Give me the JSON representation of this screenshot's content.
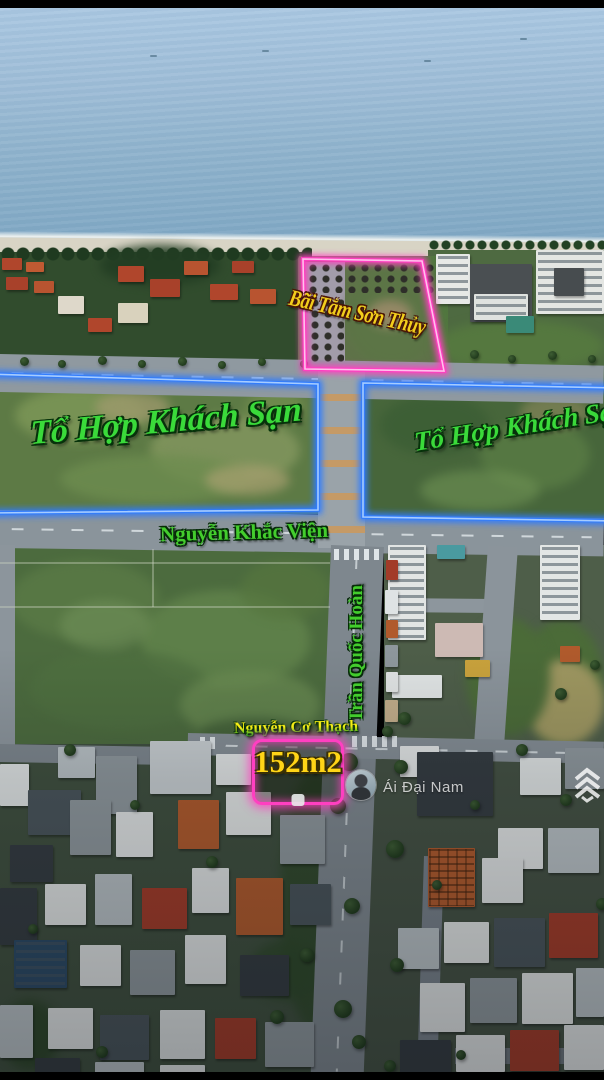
{
  "annotations": {
    "beach_area": {
      "label": "Bãi Tắm Sơn Thủy"
    },
    "parcel_left": {
      "label": "Tổ Hợp Khách Sạn"
    },
    "parcel_right": {
      "label": "Tổ Hợp Khách Sạn"
    },
    "street_nguyen_khac_vien": {
      "label": "Nguyễn Khắc Viện"
    },
    "street_tran_quoc_hoan": {
      "label": "Trần Quốc Hoàn"
    },
    "street_nguyen_co_thach": {
      "label": "Nguyễn Cơ Thạch"
    },
    "plot": {
      "area_label": "152m2"
    }
  },
  "watermark": {
    "name": "Ái Đại Nam",
    "logo_icon": "chevron-stack-logo"
  },
  "colors": {
    "neon_pink": "#ff3fc1",
    "neon_pink_core": "#ffc2ec",
    "neon_blue": "#2f7bff",
    "neon_blue_core": "#a6ccff",
    "label_green": "#3ada3a",
    "street_green": "#43cd2d",
    "label_yellow": "#f2ce1c",
    "area_yellow": "#ffd517"
  }
}
